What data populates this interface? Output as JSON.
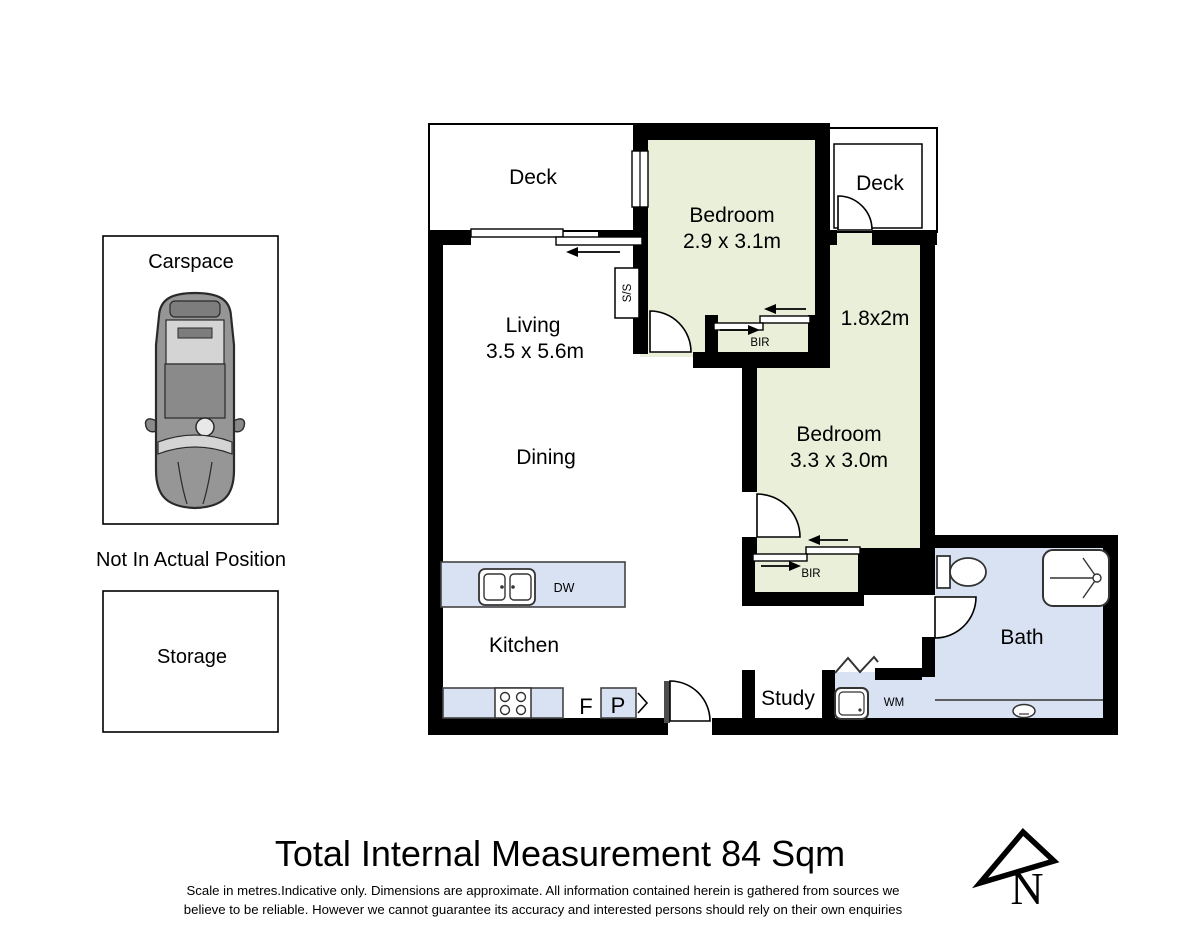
{
  "sidebar": {
    "carspace": "Carspace",
    "note": "Not In Actual Position",
    "storage": "Storage"
  },
  "rooms": {
    "deck_top_left": "Deck",
    "deck_top_right": "Deck",
    "bedroom1_name": "Bedroom",
    "bedroom1_dims": "2.9 x 3.1m",
    "nook_dims": "1.8x2m",
    "living_name": "Living",
    "living_dims": "3.5 x 5.6m",
    "dining": "Dining",
    "bedroom2_name": "Bedroom",
    "bedroom2_dims": "3.3 x 3.0m",
    "kitchen": "Kitchen",
    "study": "Study",
    "bath": "Bath"
  },
  "fixtures": {
    "stainless_steel": "S/S",
    "bir_bedroom1": "BIR",
    "bir_bedroom2": "BIR",
    "dishwasher": "DW",
    "fridge": "F",
    "pantry": "P",
    "washing_machine": "WM"
  },
  "title_block": {
    "title": "Total Internal Measurement  84 Sqm",
    "disclaimer_line1": "Scale in metres.Indicative only. Dimensions are approximate. All information contained herein is gathered from sources we",
    "disclaimer_line2": "believe to be reliable. However we cannot guarantee its accuracy and interested persons should rely on their own enquiries",
    "north_label": "N"
  },
  "colors": {
    "room_green": "#e9efd9",
    "wet_area_blue": "#d9e2f3",
    "wall_black": "#000000"
  }
}
